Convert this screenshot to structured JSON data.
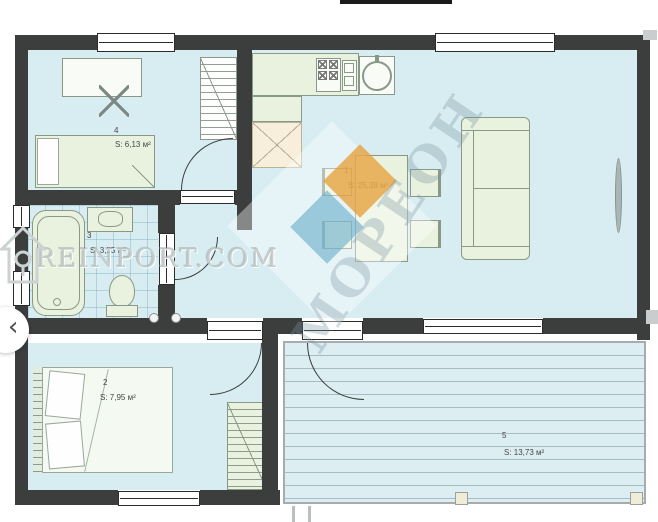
{
  "plan_type": "floor-plan",
  "rooms": [
    {
      "number": "1",
      "area": "S: 25,38 м²"
    },
    {
      "number": "2",
      "area": "S: 7,95 м²"
    },
    {
      "number": "3",
      "area": "S: 3,55 м²"
    },
    {
      "number": "4",
      "area": "S: 6,13 м²"
    },
    {
      "number": "5",
      "area": "S: 13,73 м²"
    }
  ],
  "watermarks": {
    "site": "REINPORT.COM",
    "brand_diagonal": "МОРЕОН"
  },
  "carousel": {
    "prev_label": "‹"
  },
  "colors": {
    "wall": "#3c3e3e",
    "floor": "#d8edf2",
    "furniture": "#e9f2df",
    "terrace_stripe": "#a6bcc2",
    "brand_orange": "#e69e34",
    "brand_blue": "#5aa5c3"
  }
}
